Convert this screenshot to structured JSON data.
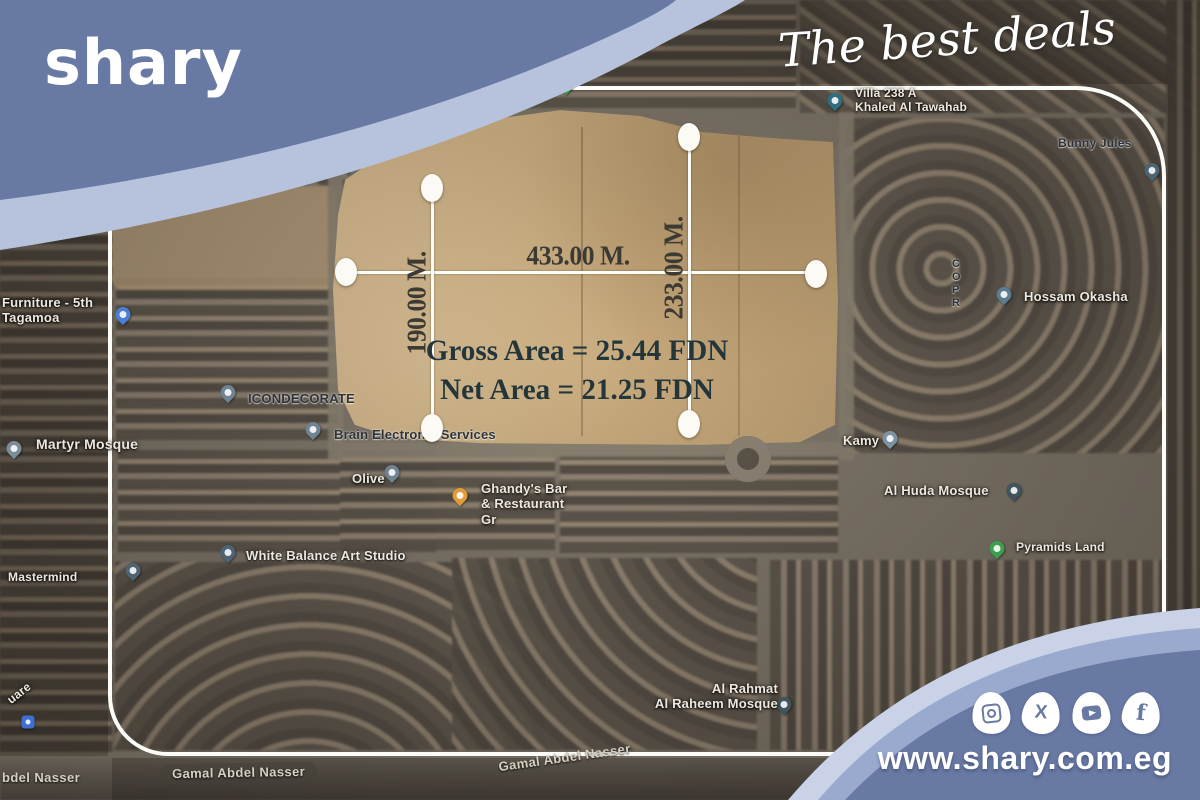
{
  "brand": {
    "logo": "shary",
    "tagline": "The best deals",
    "website": "www.shary.com.eg",
    "colors": {
      "slate": "#6879a3",
      "band_light": "#b7c2dc",
      "band_mid": "#9aaacf",
      "band_pale": "#c9d2e7",
      "frame": "#fbfbf7"
    },
    "social": [
      {
        "name": "instagram"
      },
      {
        "name": "x"
      },
      {
        "name": "youtube"
      },
      {
        "name": "facebook"
      }
    ]
  },
  "plot": {
    "width_label": "433.00 M.",
    "left_height_label": "190.00 M.",
    "right_height_label": "233.00 M.",
    "gross_area_label": "Gross Area = 25.44 FDN",
    "net_area_label": "Net Area = 21.25 FDN"
  },
  "map": {
    "pins": [
      {
        "id": "furniture-store",
        "x": 123,
        "y": 322,
        "color": "#4a7fd4",
        "label": "Furniture - 5th\nTagamoa",
        "lx": 2,
        "ly": 295,
        "style": "light",
        "size": 13
      },
      {
        "id": "martyr-mosque",
        "x": 14,
        "y": 456,
        "color": "#7d8c96",
        "label": "Martyr Mosque",
        "lx": 36,
        "ly": 436,
        "style": "light",
        "size": 14
      },
      {
        "id": "icondecorate",
        "x": 228,
        "y": 400,
        "color": "#6f8391",
        "label": "ICONDECORATE",
        "lx": 248,
        "ly": 391,
        "style": "dark",
        "size": 13
      },
      {
        "id": "brain-electronic-services",
        "x": 313,
        "y": 437,
        "color": "#6f8391",
        "label": "Brain Electronic Services",
        "lx": 334,
        "ly": 427,
        "style": "dark",
        "size": 13
      },
      {
        "id": "olive",
        "x": 392,
        "y": 480,
        "color": "#6f8391",
        "label": "Olive",
        "lx": 352,
        "ly": 471,
        "style": "light",
        "size": 13
      },
      {
        "id": "ghandys-restaurant",
        "x": 460,
        "y": 503,
        "color": "#e09c3a",
        "label": "Ghandy's Bar\n& Restaurant\nGr",
        "lx": 481,
        "ly": 481,
        "style": "light",
        "size": 13
      },
      {
        "id": "white-balance-art-studio",
        "x": 228,
        "y": 560,
        "color": "#4f6472",
        "label": "White Balance Art Studio",
        "lx": 246,
        "ly": 548,
        "style": "light",
        "size": 13
      },
      {
        "id": "kamy",
        "x": 890,
        "y": 446,
        "color": "#7d93a2",
        "label": "Kamy",
        "lx": 843,
        "ly": 433,
        "style": "light",
        "size": 13
      },
      {
        "id": "al-huda-mosque",
        "x": 1014,
        "y": 498,
        "color": "#3f545e",
        "label": "Al Huda Mosque",
        "lx": 884,
        "ly": 483,
        "style": "light",
        "size": 13
      },
      {
        "id": "hossam-okasha",
        "x": 1004,
        "y": 302,
        "color": "#5d7b8f",
        "label": "Hossam Okasha",
        "lx": 1024,
        "ly": 289,
        "style": "light",
        "size": 13
      },
      {
        "id": "villa-238a",
        "x": 835,
        "y": 108,
        "color": "#2f6e7e",
        "label": "Villa 238 A\nKhaled Al Tawahab",
        "lx": 855,
        "ly": 86,
        "style": "light",
        "size": 12
      },
      {
        "id": "park-marker",
        "x": 566,
        "y": 92,
        "color": "#3e9e4f"
      },
      {
        "id": "pyramids-land",
        "x": 997,
        "y": 556,
        "color": "#3e9e4f",
        "label": "Pyramids Land",
        "lx": 1016,
        "ly": 540,
        "style": "light",
        "size": 12
      },
      {
        "id": "al-rahmat-al-raheem-mosque",
        "x": 784,
        "y": 712,
        "color": "#42555e",
        "label": "Al Rahmat\nAl Raheem Mosque",
        "lx": 630,
        "ly": 681,
        "style": "light",
        "size": 13,
        "align": "right",
        "lw": 148
      },
      {
        "id": "mastermind",
        "x": 133,
        "y": 578,
        "color": "#4f6472",
        "label": "Mastermind",
        "lx": 8,
        "ly": 570,
        "style": "light",
        "size": 12
      },
      {
        "id": "hotel-marker",
        "x": 28,
        "y": 722,
        "color": "#3f6fd1",
        "shape": "square"
      },
      {
        "id": "edge-marker",
        "x": 1152,
        "y": 178,
        "color": "#4f6472"
      },
      {
        "id": "bunny-jules",
        "label": "Bunny Jules",
        "lx": 1058,
        "ly": 136,
        "style": "dark",
        "size": 12
      },
      {
        "id": "copr-sign",
        "label": "C\nO\nP\nR",
        "lx": 952,
        "ly": 258,
        "style": "dark",
        "size": 11
      },
      {
        "id": "square-sign",
        "label": "uare",
        "lx": 6,
        "ly": 686,
        "style": "light",
        "size": 12,
        "rot": -38
      }
    ],
    "streets": [
      {
        "id": "gamal-abdel-nasser-left",
        "text": "Gamal Abdel Nasser",
        "x": 160,
        "y": 763,
        "rot": -1,
        "pill": true
      },
      {
        "id": "gamal-abdel-nasser-mid",
        "text": "Gamal Abdel Nasser",
        "x": 498,
        "y": 750,
        "rot": -8,
        "pill": false
      },
      {
        "id": "abdel-nasser-corner",
        "text": "bdel Nasser",
        "x": 2,
        "y": 770,
        "rot": 0,
        "pill": false
      }
    ]
  }
}
